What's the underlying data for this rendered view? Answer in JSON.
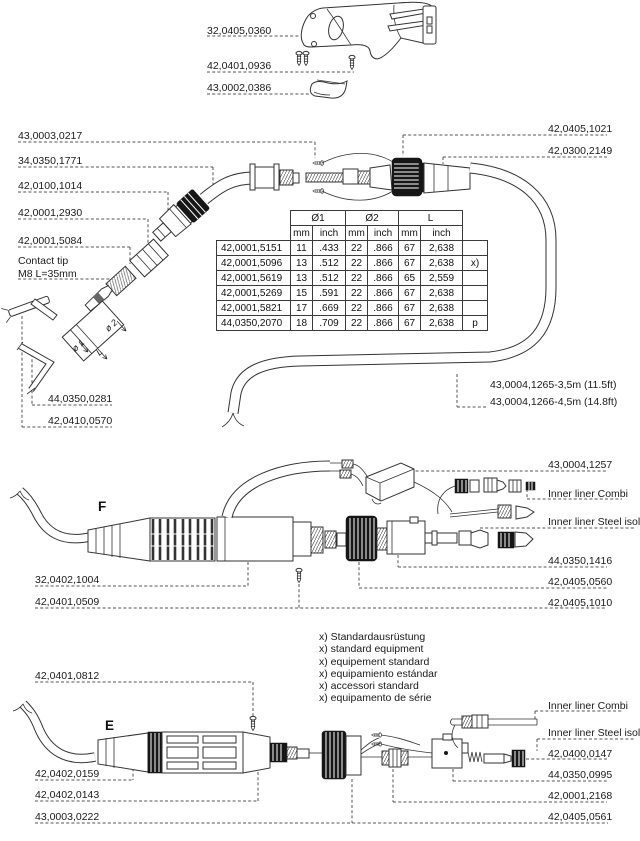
{
  "top_section": {
    "labels": [
      "32,0405,0360",
      "42,0401,0936",
      "43,0002,0386"
    ]
  },
  "neck_section": {
    "left_labels": [
      "43,0003,0217",
      "34,0350,1771",
      "42,0100,1014",
      "42,0001,2930",
      "42,0001,5084"
    ],
    "contact_tip_line1": "Contact tip",
    "contact_tip_line2": "M8 L=35mm",
    "tool_labels": [
      "44,0350,0281",
      "42,0410,0570"
    ],
    "right_labels": [
      "42,0405,1021",
      "42,0300,2149"
    ],
    "hose_labels": [
      "43,0004,1265-3,5m (11.5ft)",
      "43,0004,1266-4,5m (14.8ft)"
    ],
    "dim_labels": [
      "ø 1",
      "ø 2",
      "L"
    ]
  },
  "size_table": {
    "group_headers": [
      "Ø1",
      "Ø2",
      "L"
    ],
    "unit_headers": [
      "mm",
      "inch",
      "mm",
      "inch",
      "mm",
      "inch"
    ],
    "rows": [
      {
        "part": "42,0001,5151",
        "d1mm": "11",
        "d1in": ".433",
        "d2mm": "22",
        "d2in": ".866",
        "lmm": "67",
        "lin": "2,638",
        "note": ""
      },
      {
        "part": "42,0001,5096",
        "d1mm": "13",
        "d1in": ".512",
        "d2mm": "22",
        "d2in": ".866",
        "lmm": "67",
        "lin": "2,638",
        "note": "x)"
      },
      {
        "part": "42,0001,5619",
        "d1mm": "13",
        "d1in": ".512",
        "d2mm": "22",
        "d2in": ".866",
        "lmm": "65",
        "lin": "2,559",
        "note": ""
      },
      {
        "part": "42,0001,5269",
        "d1mm": "15",
        "d1in": ".591",
        "d2mm": "22",
        "d2in": ".866",
        "lmm": "67",
        "lin": "2,638",
        "note": ""
      },
      {
        "part": "42,0001,5821",
        "d1mm": "17",
        "d1in": ".669",
        "d2mm": "22",
        "d2in": ".866",
        "lmm": "67",
        "lin": "2,638",
        "note": ""
      },
      {
        "part": "44,0350,2070",
        "d1mm": "18",
        "d1in": ".709",
        "d2mm": "22",
        "d2in": ".866",
        "lmm": "67",
        "lin": "2,638",
        "note": "p"
      }
    ]
  },
  "section_f": {
    "marker": "F",
    "left_labels": [
      "32,0402,1004",
      "42,0401,0509"
    ],
    "right_labels": [
      "43,0004,1257",
      "Inner liner Combi",
      "Inner liner Steel isol.",
      "44,0350,1416",
      "42,0405,0560",
      "42,0405,1010"
    ]
  },
  "equipment_notes": [
    "x) Standardausrüstung",
    "x) standard equipment",
    "x) equipement standard",
    "x) equipamiento estándar",
    "x) accessori standard",
    "x) equipamento de série"
  ],
  "section_e": {
    "marker": "E",
    "left_labels": [
      "42,0401,0812",
      "42,0402,0159",
      "42,0402,0143",
      "43,0003,0222"
    ],
    "right_labels": [
      "Inner liner Combi",
      "Inner liner Steel isol.",
      "42,0400,0147",
      "44,0350,0995",
      "42,0001,2168",
      "42,0405,0561"
    ]
  }
}
